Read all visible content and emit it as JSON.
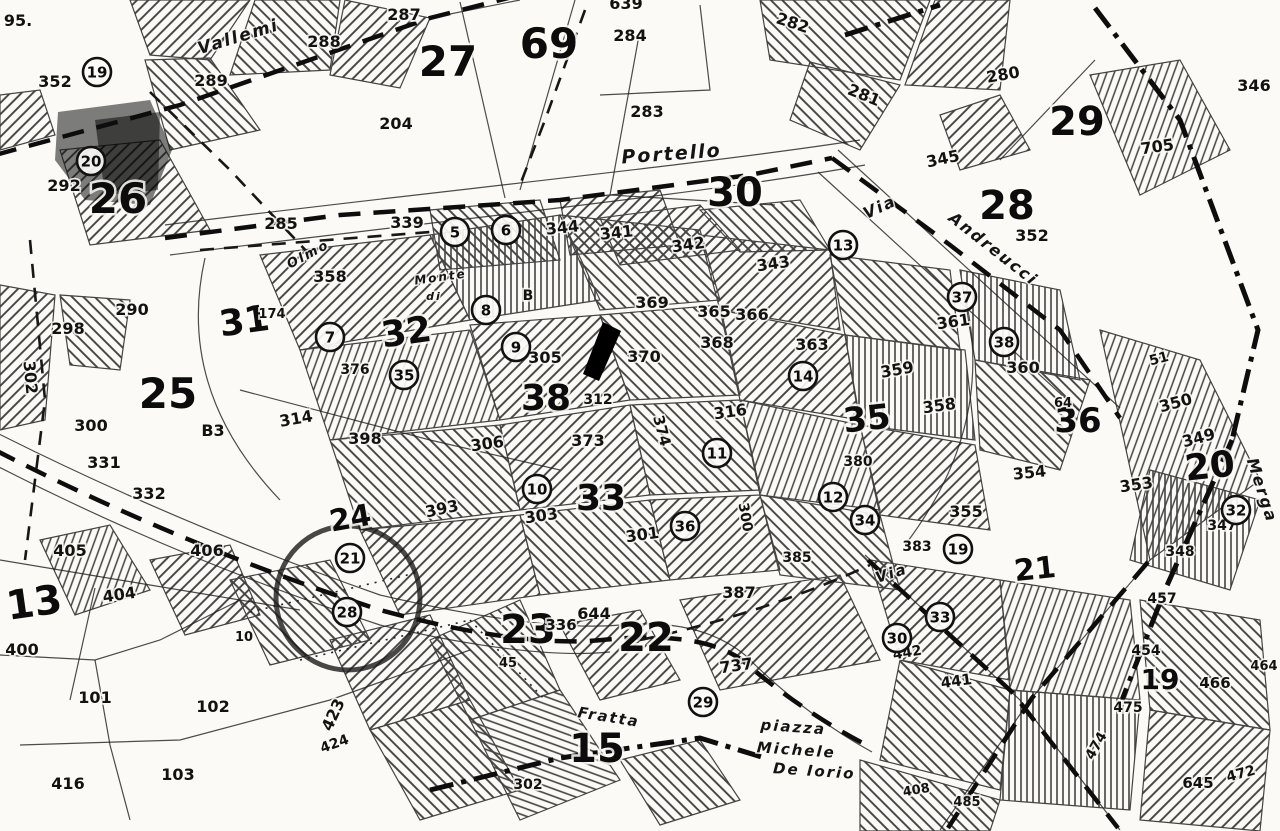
{
  "map_type": "cadastral-plan",
  "colors": {
    "paper": "#fbfaf6",
    "ink": "#111111"
  },
  "streets": [
    {
      "label": "Vallemi",
      "x": 240,
      "y": 42,
      "rotate": -17,
      "size": 17
    },
    {
      "label": "Portello",
      "x": 672,
      "y": 160,
      "rotate": -4,
      "size": 19
    },
    {
      "label": "Via",
      "x": 882,
      "y": 212,
      "rotate": -25,
      "size": 16
    },
    {
      "label": "Andreucci",
      "x": 990,
      "y": 253,
      "rotate": 38,
      "size": 16
    },
    {
      "label": "Olmo",
      "x": 310,
      "y": 258,
      "rotate": -28,
      "size": 13
    },
    {
      "label": "Monte",
      "x": 441,
      "y": 281,
      "rotate": -8,
      "size": 12
    },
    {
      "label": "di",
      "x": 434,
      "y": 300,
      "rotate": 0,
      "size": 11
    },
    {
      "label": "Merga",
      "x": 1257,
      "y": 492,
      "rotate": 72,
      "size": 16
    },
    {
      "label": "Via",
      "x": 893,
      "y": 578,
      "rotate": -18,
      "size": 15
    },
    {
      "label": "Fratta",
      "x": 608,
      "y": 722,
      "rotate": 9,
      "size": 15
    },
    {
      "label": "piazza",
      "x": 793,
      "y": 732,
      "rotate": 4,
      "size": 15
    },
    {
      "label": "Michele",
      "x": 796,
      "y": 755,
      "rotate": 4,
      "size": 15
    },
    {
      "label": "De Iorio",
      "x": 814,
      "y": 776,
      "rotate": 4,
      "size": 15
    }
  ],
  "zones": [
    {
      "n": "26",
      "x": 118,
      "y": 213,
      "size": 42,
      "rotate": 0
    },
    {
      "n": "27",
      "x": 448,
      "y": 76,
      "size": 42,
      "rotate": 0
    },
    {
      "n": "69",
      "x": 549,
      "y": 58,
      "size": 42,
      "rotate": 0
    },
    {
      "n": "30",
      "x": 735,
      "y": 206,
      "size": 40,
      "rotate": 0
    },
    {
      "n": "28",
      "x": 1007,
      "y": 219,
      "size": 40,
      "rotate": 0
    },
    {
      "n": "29",
      "x": 1077,
      "y": 135,
      "size": 40,
      "rotate": 0
    },
    {
      "n": "25",
      "x": 168,
      "y": 408,
      "size": 42,
      "rotate": 0
    },
    {
      "n": "31",
      "x": 246,
      "y": 333,
      "size": 36,
      "rotate": -8
    },
    {
      "n": "32",
      "x": 408,
      "y": 344,
      "size": 36,
      "rotate": -8
    },
    {
      "n": "38",
      "x": 546,
      "y": 410,
      "size": 36,
      "rotate": 0
    },
    {
      "n": "33",
      "x": 601,
      "y": 510,
      "size": 36,
      "rotate": 0
    },
    {
      "n": "35",
      "x": 868,
      "y": 430,
      "size": 34,
      "rotate": -6
    },
    {
      "n": "36",
      "x": 1078,
      "y": 432,
      "size": 34,
      "rotate": 0
    },
    {
      "n": "20",
      "x": 1211,
      "y": 478,
      "size": 36,
      "rotate": -6
    },
    {
      "n": "24",
      "x": 352,
      "y": 528,
      "size": 30,
      "rotate": -10
    },
    {
      "n": "13",
      "x": 36,
      "y": 616,
      "size": 40,
      "rotate": -8
    },
    {
      "n": "23",
      "x": 528,
      "y": 643,
      "size": 40,
      "rotate": 0
    },
    {
      "n": "22",
      "x": 646,
      "y": 651,
      "size": 40,
      "rotate": 0
    },
    {
      "n": "15",
      "x": 597,
      "y": 762,
      "size": 40,
      "rotate": 0
    },
    {
      "n": "21",
      "x": 1036,
      "y": 579,
      "size": 30,
      "rotate": -6
    },
    {
      "n": "19",
      "x": 1160,
      "y": 689,
      "size": 28,
      "rotate": 0
    }
  ],
  "circled": [
    {
      "n": "19",
      "x": 97,
      "y": 72
    },
    {
      "n": "20",
      "x": 91,
      "y": 161
    },
    {
      "n": "5",
      "x": 455,
      "y": 232
    },
    {
      "n": "6",
      "x": 506,
      "y": 230
    },
    {
      "n": "13",
      "x": 843,
      "y": 245
    },
    {
      "n": "8",
      "x": 486,
      "y": 310
    },
    {
      "n": "9",
      "x": 516,
      "y": 347
    },
    {
      "n": "7",
      "x": 330,
      "y": 337
    },
    {
      "n": "35",
      "x": 404,
      "y": 375
    },
    {
      "n": "37",
      "x": 962,
      "y": 297
    },
    {
      "n": "38",
      "x": 1004,
      "y": 342
    },
    {
      "n": "14",
      "x": 803,
      "y": 376
    },
    {
      "n": "11",
      "x": 717,
      "y": 453
    },
    {
      "n": "10",
      "x": 537,
      "y": 489
    },
    {
      "n": "12",
      "x": 833,
      "y": 497
    },
    {
      "n": "34",
      "x": 865,
      "y": 520
    },
    {
      "n": "36",
      "x": 685,
      "y": 526
    },
    {
      "n": "19",
      "x": 958,
      "y": 549
    },
    {
      "n": "21",
      "x": 350,
      "y": 558
    },
    {
      "n": "28",
      "x": 347,
      "y": 612
    },
    {
      "n": "29",
      "x": 703,
      "y": 702
    },
    {
      "n": "30",
      "x": 897,
      "y": 638
    },
    {
      "n": "33",
      "x": 940,
      "y": 617
    },
    {
      "n": "32",
      "x": 1236,
      "y": 510
    }
  ],
  "parcels": [
    {
      "n": "95.",
      "x": 18,
      "y": 26
    },
    {
      "n": "352",
      "x": 55,
      "y": 87
    },
    {
      "n": "292",
      "x": 64,
      "y": 191
    },
    {
      "n": "287",
      "x": 404,
      "y": 20
    },
    {
      "n": "288",
      "x": 324,
      "y": 47
    },
    {
      "n": "289",
      "x": 211,
      "y": 86
    },
    {
      "n": "204",
      "x": 396,
      "y": 129
    },
    {
      "n": "285",
      "x": 281,
      "y": 229
    },
    {
      "n": "339",
      "x": 407,
      "y": 228
    },
    {
      "n": "639",
      "x": 626,
      "y": 9
    },
    {
      "n": "284",
      "x": 630,
      "y": 41
    },
    {
      "n": "283",
      "x": 647,
      "y": 117
    },
    {
      "n": "282",
      "x": 791,
      "y": 28,
      "rotate": 18
    },
    {
      "n": "281",
      "x": 862,
      "y": 100,
      "rotate": 22
    },
    {
      "n": "280",
      "x": 1004,
      "y": 80,
      "rotate": -10
    },
    {
      "n": "705",
      "x": 1158,
      "y": 152,
      "rotate": -8
    },
    {
      "n": "345",
      "x": 944,
      "y": 164,
      "rotate": -12
    },
    {
      "n": "346",
      "x": 1254,
      "y": 91
    },
    {
      "n": "352",
      "x": 1032,
      "y": 241
    },
    {
      "n": "344",
      "x": 563,
      "y": 233,
      "rotate": -6
    },
    {
      "n": "341",
      "x": 617,
      "y": 238,
      "rotate": -6
    },
    {
      "n": "342",
      "x": 689,
      "y": 250,
      "rotate": -8
    },
    {
      "n": "343",
      "x": 774,
      "y": 269,
      "rotate": -8
    },
    {
      "n": "369",
      "x": 652,
      "y": 308
    },
    {
      "n": "365",
      "x": 714,
      "y": 317
    },
    {
      "n": "366",
      "x": 752,
      "y": 320
    },
    {
      "n": "368",
      "x": 717,
      "y": 348
    },
    {
      "n": "370",
      "x": 644,
      "y": 362
    },
    {
      "n": "363",
      "x": 812,
      "y": 350
    },
    {
      "n": "358",
      "x": 330,
      "y": 282
    },
    {
      "n": "290",
      "x": 132,
      "y": 315
    },
    {
      "n": "298",
      "x": 68,
      "y": 334
    },
    {
      "n": "302",
      "x": 25,
      "y": 378,
      "rotate": 85
    },
    {
      "n": "300",
      "x": 91,
      "y": 431
    },
    {
      "n": "331",
      "x": 104,
      "y": 468
    },
    {
      "n": "332",
      "x": 149,
      "y": 499
    },
    {
      "n": "B3",
      "x": 213,
      "y": 436
    },
    {
      "n": "174",
      "x": 272,
      "y": 318,
      "size": 13
    },
    {
      "n": "376",
      "x": 355,
      "y": 374,
      "size": 14
    },
    {
      "n": "314",
      "x": 297,
      "y": 424,
      "rotate": -10
    },
    {
      "n": "398",
      "x": 365,
      "y": 444
    },
    {
      "n": "393",
      "x": 443,
      "y": 514,
      "rotate": -12
    },
    {
      "n": "305",
      "x": 545,
      "y": 363
    },
    {
      "n": "B",
      "x": 528,
      "y": 300,
      "size": 14
    },
    {
      "n": "312",
      "x": 598,
      "y": 404,
      "size": 14
    },
    {
      "n": "373",
      "x": 588,
      "y": 446
    },
    {
      "n": "374",
      "x": 657,
      "y": 432,
      "rotate": 75,
      "size": 15
    },
    {
      "n": "306",
      "x": 488,
      "y": 449,
      "rotate": -8
    },
    {
      "n": "316",
      "x": 731,
      "y": 417,
      "rotate": -8
    },
    {
      "n": "303",
      "x": 542,
      "y": 521,
      "rotate": -8
    },
    {
      "n": "301",
      "x": 643,
      "y": 540,
      "rotate": -8
    },
    {
      "n": "300",
      "x": 741,
      "y": 518,
      "rotate": 80,
      "size": 14
    },
    {
      "n": "358",
      "x": 940,
      "y": 411,
      "rotate": -8
    },
    {
      "n": "359",
      "x": 898,
      "y": 375,
      "rotate": -10
    },
    {
      "n": "361",
      "x": 954,
      "y": 327,
      "rotate": -8
    },
    {
      "n": "360",
      "x": 1023,
      "y": 373
    },
    {
      "n": "380",
      "x": 858,
      "y": 466,
      "size": 14
    },
    {
      "n": "383",
      "x": 917,
      "y": 551,
      "size": 14
    },
    {
      "n": "385",
      "x": 797,
      "y": 562,
      "size": 14
    },
    {
      "n": "355",
      "x": 966,
      "y": 517
    },
    {
      "n": "354",
      "x": 1030,
      "y": 478,
      "rotate": -6
    },
    {
      "n": "353",
      "x": 1137,
      "y": 490,
      "rotate": -8
    },
    {
      "n": "350",
      "x": 1177,
      "y": 408,
      "rotate": -15
    },
    {
      "n": "349",
      "x": 1200,
      "y": 443,
      "rotate": -15
    },
    {
      "n": "347",
      "x": 1222,
      "y": 530,
      "size": 14
    },
    {
      "n": "348",
      "x": 1180,
      "y": 556,
      "size": 14
    },
    {
      "n": "51",
      "x": 1160,
      "y": 363,
      "size": 14,
      "rotate": -15
    },
    {
      "n": "64",
      "x": 1063,
      "y": 407,
      "size": 13
    },
    {
      "n": "405",
      "x": 70,
      "y": 556
    },
    {
      "n": "406",
      "x": 207,
      "y": 556
    },
    {
      "n": "404",
      "x": 120,
      "y": 600,
      "rotate": -8
    },
    {
      "n": "400",
      "x": 22,
      "y": 655
    },
    {
      "n": "101",
      "x": 95,
      "y": 703
    },
    {
      "n": "102",
      "x": 213,
      "y": 712
    },
    {
      "n": "103",
      "x": 178,
      "y": 780
    },
    {
      "n": "416",
      "x": 68,
      "y": 789
    },
    {
      "n": "10",
      "x": 244,
      "y": 641,
      "size": 13
    },
    {
      "n": "423",
      "x": 338,
      "y": 717,
      "rotate": -65
    },
    {
      "n": "424",
      "x": 336,
      "y": 748,
      "rotate": -20,
      "size": 14
    },
    {
      "n": "336",
      "x": 561,
      "y": 630,
      "size": 15
    },
    {
      "n": "644",
      "x": 594,
      "y": 619
    },
    {
      "n": "387",
      "x": 739,
      "y": 598
    },
    {
      "n": "737",
      "x": 737,
      "y": 671,
      "rotate": -8
    },
    {
      "n": "45",
      "x": 508,
      "y": 667,
      "size": 13
    },
    {
      "n": "302",
      "x": 528,
      "y": 789,
      "size": 14
    },
    {
      "n": "442",
      "x": 908,
      "y": 657,
      "rotate": -10,
      "size": 14
    },
    {
      "n": "441",
      "x": 957,
      "y": 686,
      "rotate": -8,
      "size": 15
    },
    {
      "n": "457",
      "x": 1162,
      "y": 603,
      "size": 14
    },
    {
      "n": "454",
      "x": 1146,
      "y": 655,
      "size": 14
    },
    {
      "n": "475",
      "x": 1128,
      "y": 712,
      "size": 14
    },
    {
      "n": "474",
      "x": 1100,
      "y": 748,
      "size": 14,
      "rotate": -60
    },
    {
      "n": "466",
      "x": 1215,
      "y": 688,
      "size": 15
    },
    {
      "n": "464",
      "x": 1264,
      "y": 670,
      "size": 13
    },
    {
      "n": "645",
      "x": 1198,
      "y": 788,
      "size": 15
    },
    {
      "n": "472",
      "x": 1242,
      "y": 778,
      "size": 14,
      "rotate": -15
    },
    {
      "n": "485",
      "x": 967,
      "y": 806,
      "size": 13
    },
    {
      "n": "408",
      "x": 917,
      "y": 794,
      "size": 13,
      "rotate": -10
    }
  ]
}
